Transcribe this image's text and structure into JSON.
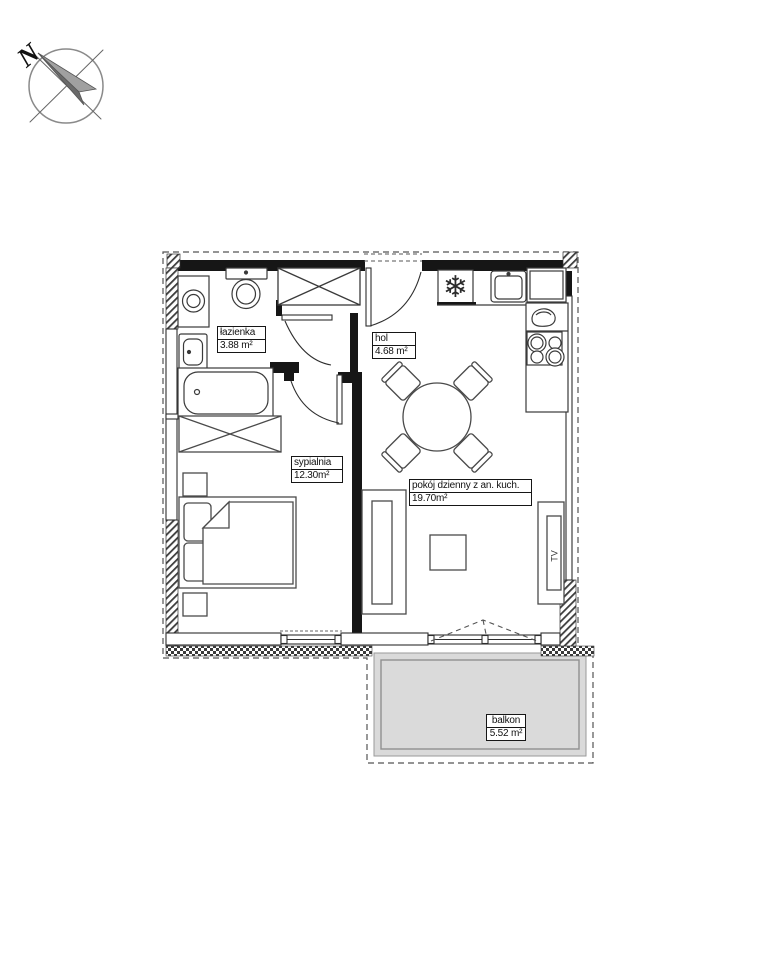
{
  "compass": {
    "north_label": "N"
  },
  "icons": {
    "snowflake": "❄"
  },
  "rooms": [
    {
      "name": "łazienka",
      "area": "3.88 m²"
    },
    {
      "name": "hol",
      "area": "4.68 m²"
    },
    {
      "name": "sypialnia",
      "area": "12.30m²"
    },
    {
      "name": "pokój dzienny z an. kuch.",
      "area": "19.70m²"
    },
    {
      "name": "balkon",
      "area": "5.52 m²"
    }
  ],
  "furniture": {
    "tv_label": "TV"
  },
  "colors": {
    "wall": "#161616",
    "line": "#2e2e2e",
    "furniture_line": "#4a4a4a",
    "balcony_fill": "#dadada",
    "boundary_dash": "#555555"
  }
}
